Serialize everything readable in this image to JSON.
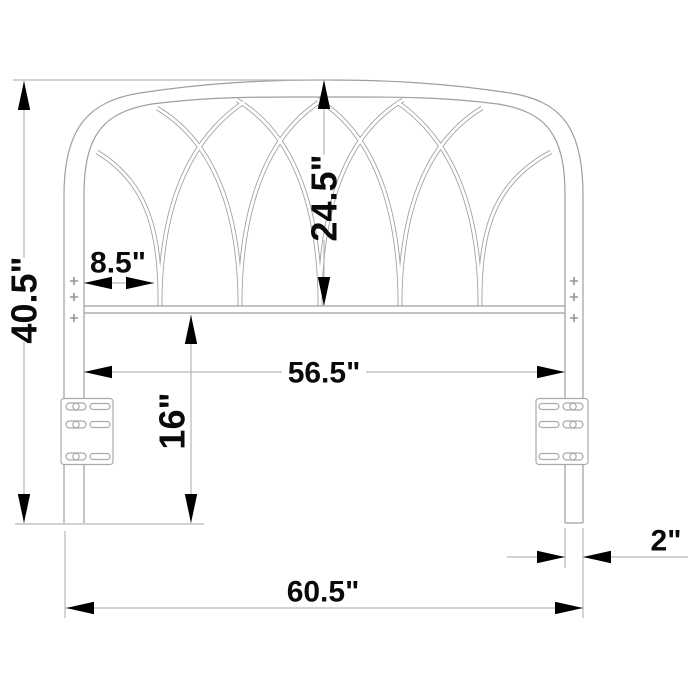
{
  "diagram": {
    "subject": "headboard-dimension-drawing",
    "dimensions": {
      "overall_height": "40.5\"",
      "arch_inner_height": "24.5\"",
      "side_panel_width": "8.5\"",
      "inner_width": "56.5\"",
      "lower_leg_height": "16\"",
      "leg_width": "2\"",
      "overall_width": "60.5\""
    },
    "colors": {
      "structure_line": "#9aa0a3",
      "dimension_line": "#b6b6b6",
      "arrow": "#000000",
      "text": "#0a0a0a",
      "background": "#ffffff"
    }
  }
}
